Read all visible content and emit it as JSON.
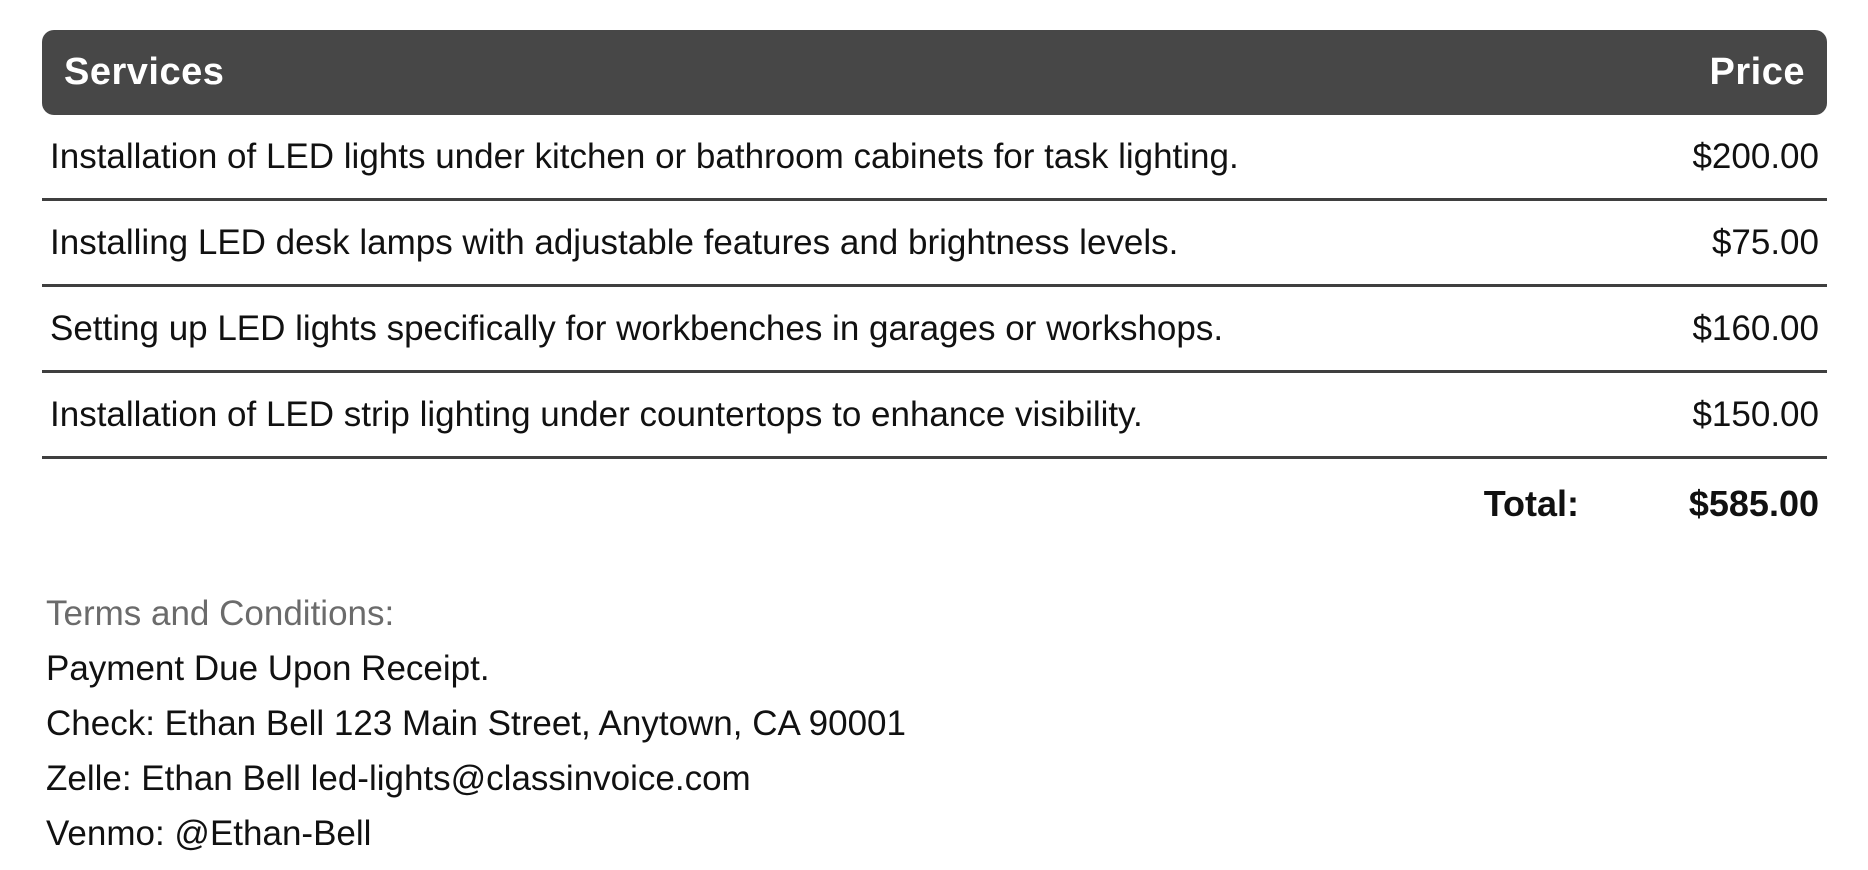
{
  "table": {
    "header": {
      "services_label": "Services",
      "price_label": "Price"
    },
    "rows": [
      {
        "description": "Installation of LED lights under kitchen or bathroom cabinets for task lighting.",
        "price": "$200.00"
      },
      {
        "description": "Installing LED desk lamps with adjustable features and brightness levels.",
        "price": "$75.00"
      },
      {
        "description": "Setting up LED lights specifically for workbenches in garages or workshops.",
        "price": "$160.00"
      },
      {
        "description": "Installation of LED strip lighting under countertops to enhance visibility.",
        "price": "$150.00"
      }
    ],
    "total": {
      "label": "Total:",
      "value": "$585.00"
    }
  },
  "terms": {
    "heading": "Terms and Conditions:",
    "lines": [
      "Payment Due Upon Receipt.",
      "Check: Ethan Bell 123 Main Street, Anytown, CA 90001",
      "Zelle: Ethan Bell led-lights@classinvoice.com",
      "Venmo: @Ethan-Bell"
    ]
  },
  "colors": {
    "header_bg": "#474747",
    "header_text": "#ffffff",
    "body_text": "#111111",
    "separator": "#3f3f3f",
    "terms_heading_text": "#6b6b6b"
  }
}
